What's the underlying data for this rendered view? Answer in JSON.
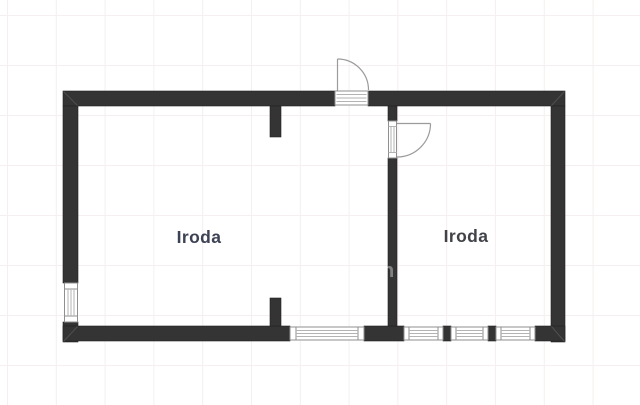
{
  "floorplan": {
    "title": "Floor plan with two offices",
    "rooms": [
      {
        "label": "Iroda",
        "color": "#3d4254"
      },
      {
        "label": "Iroda",
        "color": "#414349"
      }
    ],
    "watermark": {
      "glyph": "n",
      "color": "#ffffff"
    },
    "colors": {
      "wall": "#343434",
      "grid": "#f5efef",
      "window_frame": "#8f8f8f",
      "door_arc": "#9b9b9b",
      "background": "#ffffff"
    },
    "features": {
      "doors": [
        "entry-door-top",
        "interior-door"
      ],
      "windows": [
        "left-wall-window",
        "bottom-wall-window-left-room",
        "bottom-wall-window-right-1",
        "bottom-wall-window-right-2",
        "bottom-wall-window-right-3"
      ]
    }
  }
}
